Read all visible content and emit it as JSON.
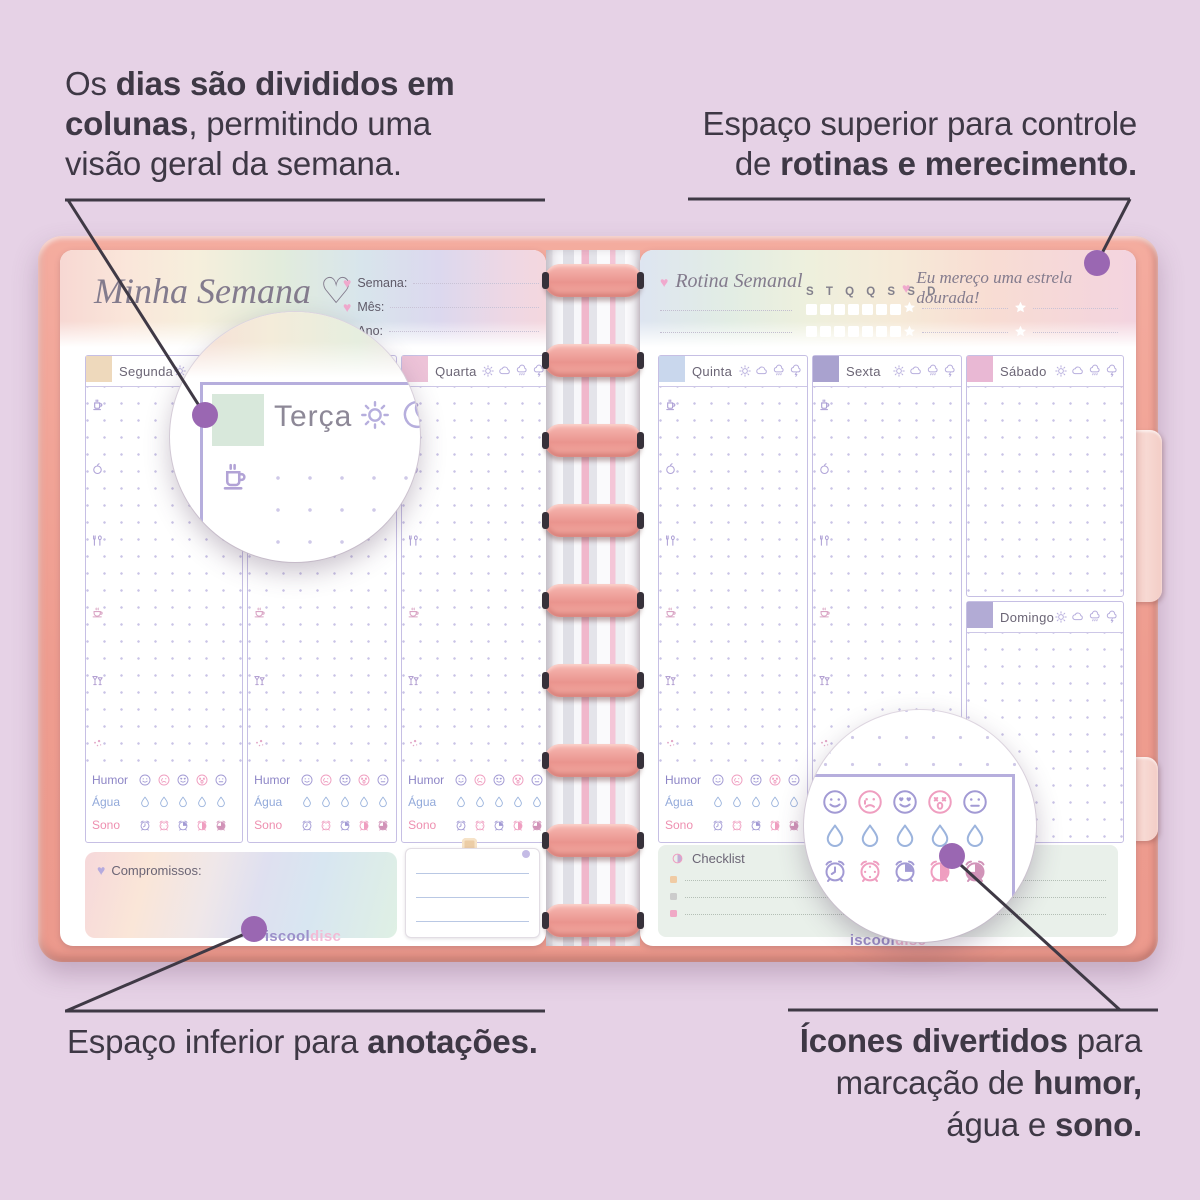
{
  "image_type": "annotated-planner-product-infographic",
  "background_color": "#e6d2e6",
  "annotations": {
    "top_left": {
      "a": "Os ",
      "a_bold": "dias são divididos em",
      "b_bold": "colunas",
      "b": ", permitindo uma",
      "c": "visão geral da semana."
    },
    "top_right": {
      "a": "Espaço superior para controle",
      "b": "de ",
      "b_bold": "rotinas e merecimento."
    },
    "bottom_left": {
      "a": "Espaço inferior para ",
      "a_bold": "anotações."
    },
    "bottom_right": {
      "a_bold": "Ícones divertidos",
      "a": " para",
      "b": "marcação de ",
      "b_bold": "humor,",
      "c": "água e ",
      "c_bold": "sono."
    }
  },
  "planner": {
    "left_page": {
      "title": "Minha Semana",
      "title_heart": "♡",
      "fields": [
        {
          "label": "Semana:"
        },
        {
          "label": "Mês:"
        },
        {
          "label": "Ano:"
        }
      ],
      "days": [
        {
          "name": "Segunda",
          "color": "#eed9bc"
        },
        {
          "name": "Terça",
          "color": "#d8e8db"
        },
        {
          "name": "Quarta",
          "color": "#edc3d8"
        }
      ],
      "tracker_labels": {
        "humor": "Humor",
        "agua": "Água",
        "sono": "Sono"
      },
      "compromissos_label": "Compromissos:",
      "brand": {
        "part1": "iscool",
        "part2": "disc"
      }
    },
    "right_page": {
      "rotina_label": "Rotina Semanal",
      "week_letters": "S T Q Q S S D",
      "estrela_label": "Eu mereço uma estrela dourada!",
      "days": [
        {
          "name": "Quinta",
          "color": "#c9d7ed"
        },
        {
          "name": "Sexta",
          "color": "#a9a2cf"
        },
        {
          "name": "Sábado",
          "color": "#e9b8d4"
        },
        {
          "name": "Domingo",
          "color": "#b2abd5"
        }
      ],
      "tracker_labels": {
        "humor": "Humor",
        "agua": "Água",
        "sono": "Sono"
      },
      "checklist_label": "Checklist",
      "checklist_bullets": [
        {
          "color": "#f0cba4"
        },
        {
          "color": "#cccccc"
        },
        {
          "color": "#f0a9c6"
        }
      ],
      "brand": {
        "part1": "iscool",
        "part2": "disc"
      }
    },
    "magnifier_left": {
      "day": "Terça"
    },
    "colors": {
      "cover": "#f0a094",
      "disc": "#ee9d98",
      "callout_line": "#3f3945",
      "callout_dot": "#9a67b2",
      "grid_border": "#c6bfe4",
      "humor_label": "#8d85c6",
      "agua_label": "#92a9da",
      "sono_label": "#ee8fb0"
    }
  },
  "icons": {
    "heart-icon": "♥",
    "heart-outline-icon": "♡",
    "star-icon": "★",
    "sun-icon": "sun with rays",
    "cloud-icon": "cloud outline",
    "rain-cloud-icon": "cloud with rain",
    "storm-cloud-icon": "cloud with lightning",
    "coffee-icon": "mug with steam",
    "apple-icon": "apple",
    "cutlery-icon": "fork and spoon",
    "teacup-icon": "teacup on saucer",
    "cocktail-icon": "two cocktail glasses",
    "sparkle-icon": "sparkle dots",
    "mood-happy-icon": "smiling face",
    "mood-sad-icon": "sad face with tear",
    "mood-love-icon": "heart-eyes face",
    "mood-shock-icon": "x-eyes open-mouth face",
    "mood-neutral-icon": "neutral face",
    "water-drop-icon": "water drop",
    "clock-empty-icon": "alarm clock with hands",
    "clock-dots-icon": "alarm clock dotted",
    "clock-quarter-icon": "alarm clock quarter filled",
    "clock-half-icon": "alarm clock half filled",
    "clock-threequarter-icon": "alarm clock mostly filled",
    "checklist-icon": "two-tone circle",
    "clip-icon": "paper clip tab"
  }
}
